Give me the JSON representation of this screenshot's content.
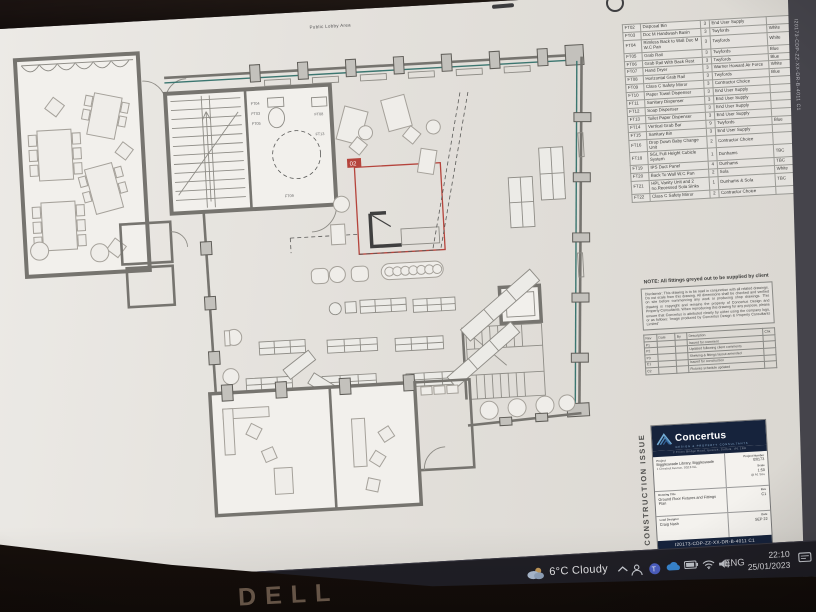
{
  "plan": {
    "top_label": "Public Lobby Area",
    "revision_marker": "02",
    "wc_labels": [
      "FT04",
      "FT03",
      "FT05",
      "FT08",
      "FT13",
      "FT09"
    ]
  },
  "fixtures_table": {
    "rows": [
      [
        "FT02",
        "Disposal Bin",
        "3",
        "End User Supply",
        ""
      ],
      [
        "FT03",
        "Doc M Handwash Basin",
        "3",
        "Twyfords",
        "White"
      ],
      [
        "FT04",
        "Rimless Back to Wall Doc M W.C Pan",
        "3",
        "Twyfords",
        "White"
      ],
      [
        "FT05",
        "Grab Rail",
        "3",
        "Twyfords",
        "Blue"
      ],
      [
        "FT06",
        "Grab Rail With Back Rest",
        "3",
        "Twyfords",
        "Blue"
      ],
      [
        "FT07",
        "Hand Dryer",
        "3",
        "Warner Howard Air Force",
        "White"
      ],
      [
        "FT08",
        "Horizontal Grab Rail",
        "3",
        "Twyfords",
        "Blue"
      ],
      [
        "FT09",
        "Class C Safety Mirror",
        "3",
        "Contractor Choice",
        ""
      ],
      [
        "FT10",
        "Paper Towel Dispenser",
        "3",
        "End User Supply",
        ""
      ],
      [
        "FT11",
        "Sanitary Dispenser",
        "3",
        "End User Supply",
        ""
      ],
      [
        "FT12",
        "Soap Dispenser",
        "3",
        "End User Supply",
        ""
      ],
      [
        "FT13",
        "Toilet Paper Dispenser",
        "3",
        "End User Supply",
        ""
      ],
      [
        "FT14",
        "Vertical Grab Bar",
        "9",
        "Twyfords",
        "Blue"
      ],
      [
        "FT15",
        "Sanitary Bin",
        "3",
        "End User Supply",
        ""
      ],
      [
        "FT16",
        "Drop Down Baby Change Unit",
        "2",
        "Contractor Choice",
        ""
      ],
      [
        "FT18",
        "SGL Full Height Cubicle System",
        "1",
        "Dunhams",
        "TBC"
      ],
      [
        "FT19",
        "IPS Duct Panel",
        "4",
        "Dunhams",
        "TBC"
      ],
      [
        "FT20",
        "Back To Wall W.C Pan",
        "2",
        "Sola",
        "White"
      ],
      [
        "FT21",
        "HPL Vanity Unit and 2 no.Recessed Sola Sinks",
        "1",
        "Dunhams & Sola",
        "TBC"
      ],
      [
        "FT22",
        "Class C Safety Mirror",
        "2",
        "Contractor Choice",
        ""
      ]
    ]
  },
  "note": {
    "heading": "NOTE: All fittings greyed out to be supplied by client",
    "disclaimer": "Disclaimer: This drawing is to be read in conjunction with all related drawings. Do not scale from this drawing. All dimensions shall be checked and verified on site before commencing any work or producing shop drawings. This drawing is copyright and remains the property of Concertus Design and Property Consultants. When reproducing this drawing for any purpose, please ensure that Concertus is attributed clearly by either using the company logo, or as follows: 'Image produced by Concertus Design & Property Consultants Limited'"
  },
  "revision_table": {
    "headers": [
      "Rev",
      "Date",
      "By",
      "Description",
      "Chk"
    ],
    "rows": [
      [
        "P1",
        "",
        "",
        "Issued for comment",
        ""
      ],
      [
        "P2",
        "",
        "",
        "Updated following client comments",
        ""
      ],
      [
        "P3",
        "",
        "",
        "Shelving & fittings layout amended",
        ""
      ],
      [
        "C1",
        "",
        "",
        "Issued for construction",
        ""
      ],
      [
        "C2",
        "",
        "",
        "Fixtures schedule updated",
        ""
      ]
    ]
  },
  "title_block": {
    "logo_name": "Concertus",
    "logo_tagline": "DESIGN & PROPERTY CONSULTANTS",
    "logo_address": "2 Friars Bridge Road, Ipswich, Suffolk, IP1 1RR",
    "project_label": "Project",
    "project_name": "Biggleswade Library, Biggleswade",
    "project_address": "1 Chestnut Avenue, SG18 0LL",
    "project_number_label": "Project Number",
    "project_number": "I20173",
    "scale_label": "Scale",
    "scale": "1:50",
    "scale_note": "@ A1 Size",
    "drawing_title_label": "Drawing Title",
    "drawing_title": "Ground Floor Fixtures and Fittings Plan",
    "rev_label": "Rev",
    "rev": "C1",
    "lead_label": "Lead Designer",
    "lead": "Craig Nash",
    "date_label": "Date",
    "date": "SEP 22",
    "drawing_number": "I20173-CDP-ZZ-XX-DR-B-4011 C1",
    "issue_stamp": "CONSTRUCTION ISSUE"
  },
  "sheet": {
    "edge_number": "I20173-CDP-ZZ-XX-DR-B-4011 C1"
  },
  "taskbar": {
    "weather": "6°C Cloudy",
    "lang": "ENG",
    "time": "22:10",
    "date": "25/01/2023",
    "notif_count": "15"
  },
  "bezel": {
    "brand": "DELL"
  },
  "colors": {
    "accent_teal": "#3b7670",
    "revision_red": "#b5443c",
    "logo_navy": "#16233c",
    "logo_blue": "#74aed6"
  }
}
